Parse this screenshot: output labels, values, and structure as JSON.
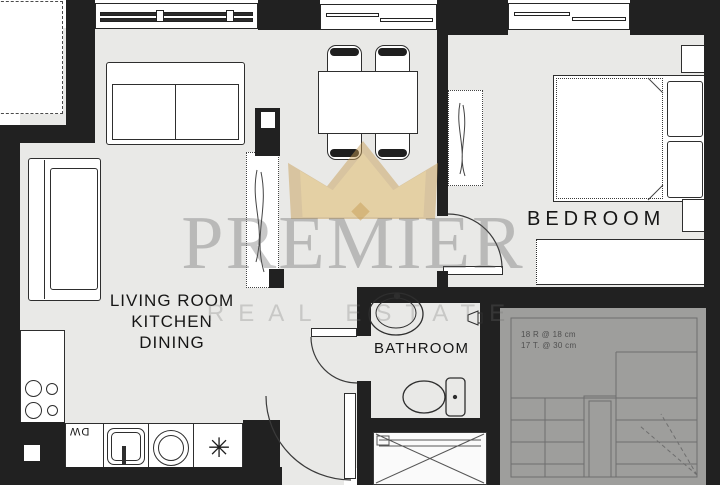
{
  "watermark": {
    "brand": "PREMIER",
    "tagline": "REAL ESTATE"
  },
  "rooms": {
    "living": {
      "lines": [
        "LIVING ROOM",
        "KITCHEN",
        "DINING"
      ]
    },
    "bedroom": {
      "label": "BEDROOM"
    },
    "bathroom": {
      "label": "BATHROOM"
    }
  },
  "kitchen": {
    "dishwasher_label": "DW",
    "burner_star_glyph": "✳"
  },
  "stairs": {
    "note_lines": [
      "18 R @ 18 cm",
      "17 T. @ 30 cm"
    ]
  },
  "furniture": {
    "living_kitchen": [
      "sofa",
      "chaise-sofa",
      "tv-unit",
      "dining-table",
      "dining-chairs",
      "stove",
      "dishwasher",
      "kitchen-sink",
      "counter"
    ],
    "bedroom": [
      "double-bed",
      "pillows",
      "wardrobe",
      "dresser",
      "nightstands"
    ],
    "bathroom": [
      "washbasin",
      "toilet"
    ],
    "circulation": [
      "staircase",
      "elevator",
      "entry-door",
      "bathroom-door",
      "bedroom-door"
    ]
  },
  "colors": {
    "wall": "#212121",
    "floor": "#e9e9e7",
    "stairs_fill": "#9e9e9c",
    "crown_gold": "#c69c54",
    "watermark_gray": "#8a8a8a"
  }
}
